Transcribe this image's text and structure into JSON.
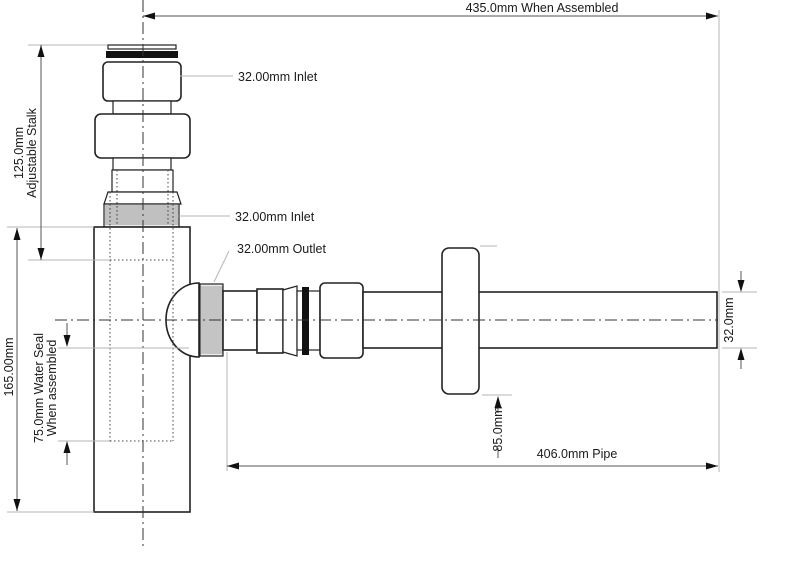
{
  "drawing": {
    "type": "technical-diagram",
    "units": "mm"
  },
  "annotations": {
    "assembled": "435.0mm When Assembled",
    "body_height": "165.00mm",
    "stalk_l1": "125.0mm",
    "stalk_l2": "Adjustable Stalk",
    "water_seal_l1": "75.0mm Water Seal",
    "water_seal_l2": "When assembled",
    "inlet_top": "32.00mm Inlet",
    "inlet_mid": "32.00mm Inlet",
    "outlet": "32.00mm Outlet",
    "flange_offset": "85.0mm",
    "pipe_length": "406.0mm Pipe",
    "pipe_diameter": "32.0mm"
  },
  "colors": {
    "outline": "#222222",
    "seal": "#111111",
    "dimension": "#555555",
    "extension": "#b5b5b5",
    "text": "#1a1a1a",
    "thread_fill": "#ededed",
    "background": "#ffffff"
  }
}
